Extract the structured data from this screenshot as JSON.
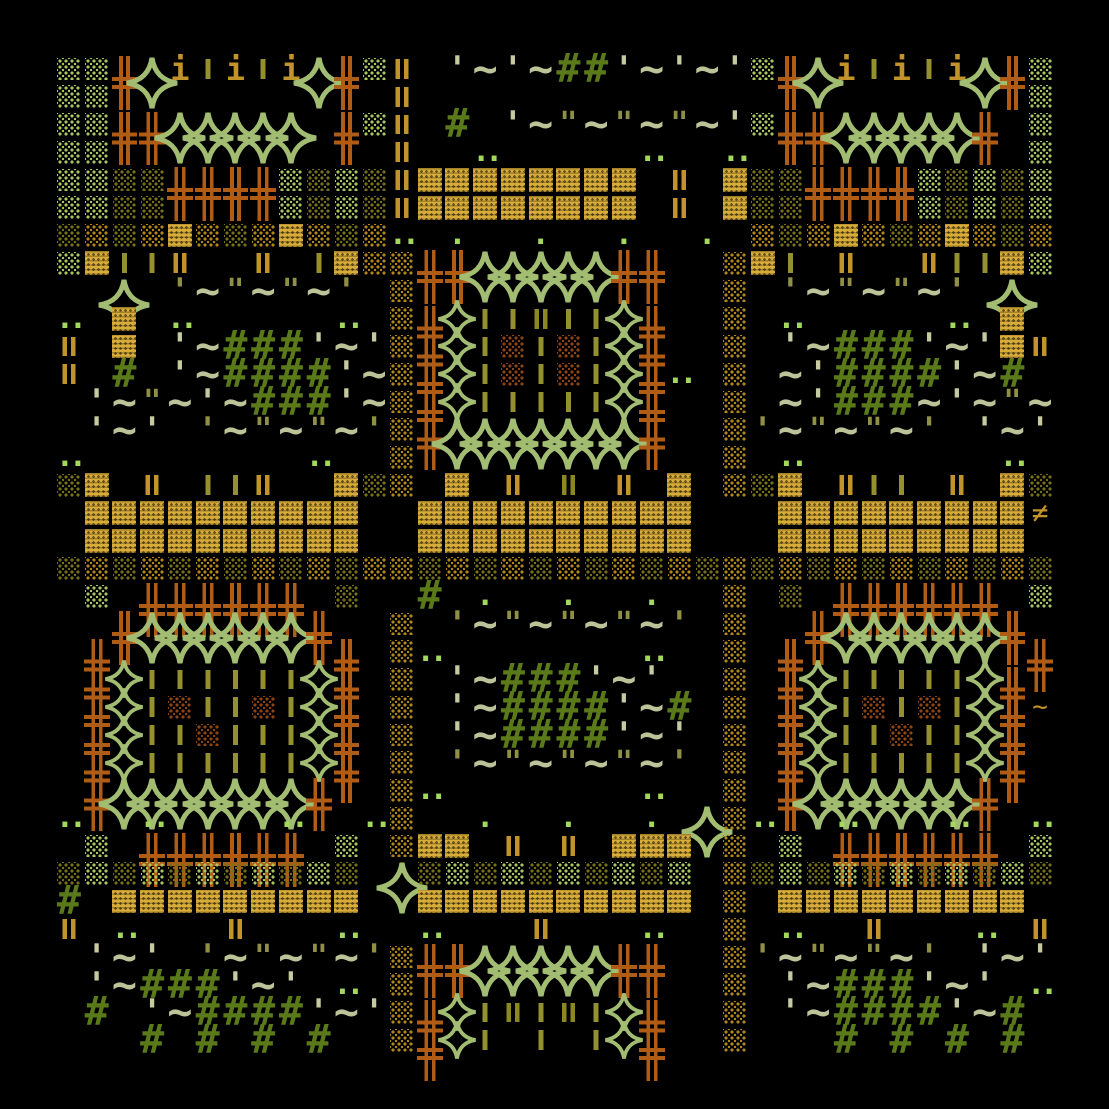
{
  "canvas": {
    "width": 1109,
    "height": 1109,
    "margin": 55,
    "cell": 27.75,
    "background": "#000000"
  },
  "palette": {
    "D": {
      "kind": "dots",
      "color": "#a9c562",
      "name": "dotted-block-lightgreen"
    },
    "E": {
      "kind": "dots",
      "color": "#76701a",
      "name": "dotted-block-olive"
    },
    "F": {
      "kind": "dots",
      "color": "#b0861a",
      "name": "dotted-block-gold"
    },
    "R": {
      "kind": "dots",
      "color": "#8a4512",
      "name": "dotted-block-rust"
    },
    "G": {
      "kind": "weave",
      "color": "#d8ac38",
      "name": "weave-block-gold"
    },
    "H": {
      "kind": "vbars",
      "n": 2,
      "color": "#c1932a",
      "name": "double-bar-gold"
    },
    "h": {
      "kind": "vbars",
      "n": 2,
      "color": "#8b8820",
      "name": "double-bar-olive"
    },
    "l": {
      "kind": "vbars",
      "n": 1,
      "color": "#949030",
      "name": "single-bar-olive"
    },
    "I": {
      "kind": "text",
      "char": "i",
      "color": "#c1932a",
      "fs": 32,
      "bold": true,
      "name": "i-bar-gold"
    },
    "X": {
      "kind": "cross",
      "color": "#b05c14",
      "tall": true,
      "name": "cross-orange"
    },
    "+": {
      "kind": "cross",
      "color": "#b05c14",
      "name": "cross-orange-small"
    },
    "z": {
      "kind": "cross",
      "color": "#8f7d1c",
      "name": "cross-olive-small"
    },
    "*": {
      "kind": "spark",
      "color": "#a2bd72",
      "size": 40,
      "name": "sparkle-icon"
    },
    "S": {
      "kind": "spark",
      "color": "#a2bd72",
      "size": 54,
      "tall": true,
      "name": "sparkle-large-icon"
    },
    "q": {
      "kind": "text",
      "char": "'",
      "color": "#c6caa0",
      "fs": 34,
      "bold": true,
      "name": "quote-sage"
    },
    "k": {
      "kind": "text",
      "char": "'",
      "color": "#8f8f45",
      "fs": 34,
      "bold": true,
      "name": "quote-olive"
    },
    "K": {
      "kind": "text",
      "char": "\"",
      "color": "#8f8f45",
      "fs": 30,
      "bold": true,
      "name": "ditto-olive"
    },
    "~": {
      "kind": "text",
      "char": "~",
      "color": "#bdc398",
      "fs": 42,
      "bold": true,
      "name": "tilde-sage"
    },
    "#": {
      "kind": "text",
      "char": "#",
      "color": "#5a7a1a",
      "fs": 40,
      "bold": true,
      "name": "hash-olive"
    },
    ":": {
      "kind": "text",
      "char": "..",
      "color": "#a2d95c",
      "fs": 30,
      "bold": true,
      "ls": -5,
      "name": "dot-pair"
    },
    ",": {
      "kind": "text",
      "char": ".",
      "color": "#a2d95c",
      "fs": 30,
      "bold": true,
      "name": "dot"
    },
    "=": {
      "kind": "text",
      "char": "≠",
      "color": "#c1932a",
      "fs": 28,
      "name": "not-equal-gold"
    },
    "-": {
      "kind": "text",
      "char": "~",
      "color": "#c1932a",
      "fs": 26,
      "name": "tilde-gold"
    }
  },
  "grid": {
    "rows": [
      "DDXSIlIlISXDH.q~q~##q~q~qDXSIlIlISXD",
      "DD..........H......................D",
      "DDXXSSSSS.XDH.#.q~K~K~K~qDXXSSSSSX.D",
      "DD..........H..:.....:..:..........D",
      "DDEEXXXXDEDEHGGGGGGGG.H.GEEXXXXDEDED",
      "DDEE....DEDEHGGGGGGGG.H.GEE....DEDED",
      "EFEFGFEFGFEF:.,..,..,..,.FEFGFEFGFEF",
      "DGllH..H.lGFFXXSSSSSXX..FGl.H..HllGD",
      "..S.k~K~K~k.F...........F.k~K~K~k.S.",
      ":.G.:.....:.FX*llhll*X..F.:.....:.G.",
      "H.G.q~###q~qFX*lRlRl*X..F.q~###q~qGH",
      "H.#.q~####q~FX*lRlRl*X:.F.~q####q~#.",
      ".q~K~q~###q~FX*lllll*X..F.~q###~q~K~",
      ".q~q.k~K~K~kFXSSSSSSSX..Fk~K~K~k.q~q",
      ":........:..F...........F.:.......:.",
      "EG.H.llH..GEF.G.H.h.H.G.FEG.Hll.H.GE",
      ".GGGGGGGGGG..GGGGGGGGGG...GGGGGGGGG=",
      ".GGGGGGGGGG..GGGGGGGGGG...GGGGGGGGG.",
      "EFEFEFEFEFEFFEFEFEFEFEFEFEFEFEFEFEFE",
      ".D.XXXXXX.E..#.,..,..,..F.E.XXXXXX.D",
      "..XSSSSSSX..F.k~K~K~K~k.F..XSSSSSSX.",
      ".X........X.F:.......:..F.X........X",
      ".X*llllll*X.F.q~###q~q..F.X*lllll*X.",
      ".X*lRllRl*X.F.q~####q~#.F.X*lRlRl*X-",
      ".X*llRlll*X.F.q~####q~q.F.X*llRll*X.",
      ".X*llllll*X.F.k~K~K~K~k.F.X*lllll*X.",
      ".XSSSSSSSX..F:.......:..F.XSSSSSSX..",
      ":..:....:..:F..,..,..,.SF:..:...:..:",
      ".D.XXXXXX.D.FGG.H.H.GGG.F.D.XXXXXX.D",
      "EDEDEDEDEDE.SEDEDEDEDED.FEDEDEDEDEDE",
      "#.GGGGGGGGG..GGGGGGGGGG.F.GGGGGGGGG.",
      "H.:...H...:..:...H...:..F.:..H...:.H",
      ".q~q.k~K~K~kFXXSSSSSXX..Fk~K~K~k.q~q",
      ".q~###q~q.:.F...........F.q~###q~q.:",
      ".#.q~####q~qFX*lhlhl*X..F.q~####q~#.",
      "...#.#.#.#..FX*l.l.l*X..F...#.#.#.#."
    ]
  }
}
